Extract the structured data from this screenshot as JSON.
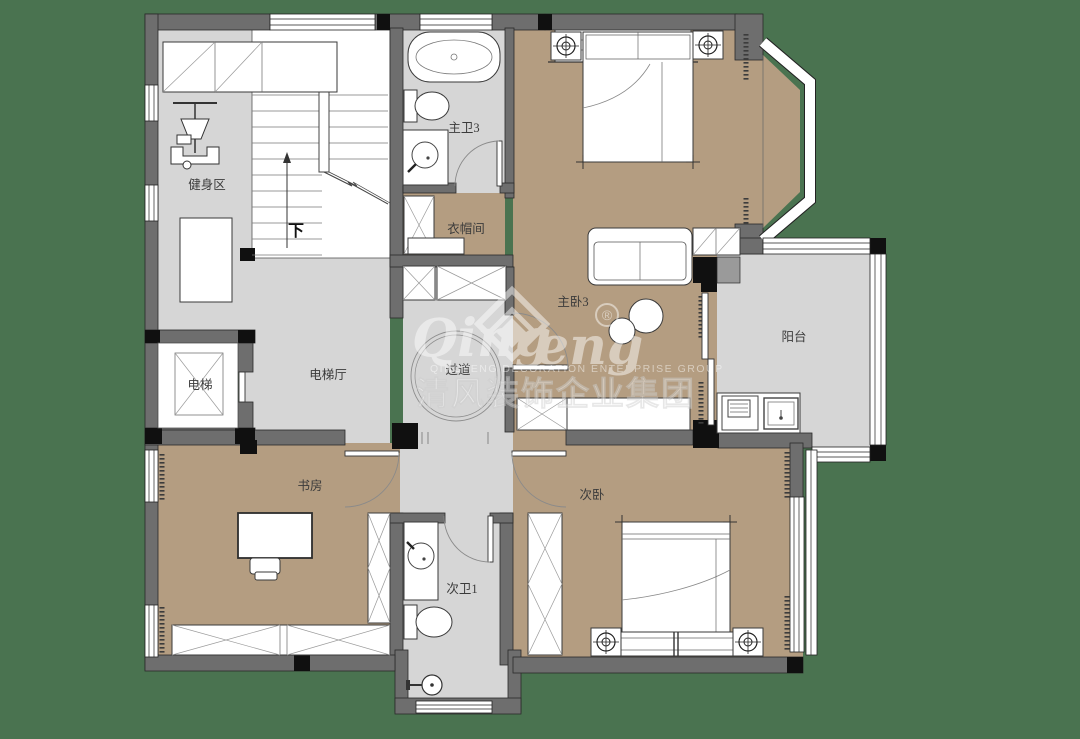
{
  "canvas": {
    "width": 1080,
    "height": 739,
    "background": "#4a7350"
  },
  "colors": {
    "background_green": "#4a7350",
    "wall_gray": "#6e6e6e",
    "column_black": "#101010",
    "floor_gray": "#d6d6d6",
    "floor_tan": "#b49d81",
    "furniture_white": "#ffffff"
  },
  "rooms": {
    "gym": "健身区",
    "master_bath": "主卫3",
    "cloakroom": "衣帽间",
    "master_bedroom": "主卧3",
    "balcony": "阳台",
    "elevator": "电梯",
    "elevator_hall": "电梯厅",
    "corridor": "过道",
    "study": "书房",
    "second_bedroom": "次卧",
    "second_bath": "次卫1"
  },
  "stairs": {
    "down_label": "下"
  },
  "watermark": {
    "logo_left": "Qing",
    "logo_right": "eng",
    "registered": "®",
    "tagline": "QINGFENG  DECORATION  ENTERPRISE  GROUP",
    "company_cn": "清风装饰企业集团"
  }
}
